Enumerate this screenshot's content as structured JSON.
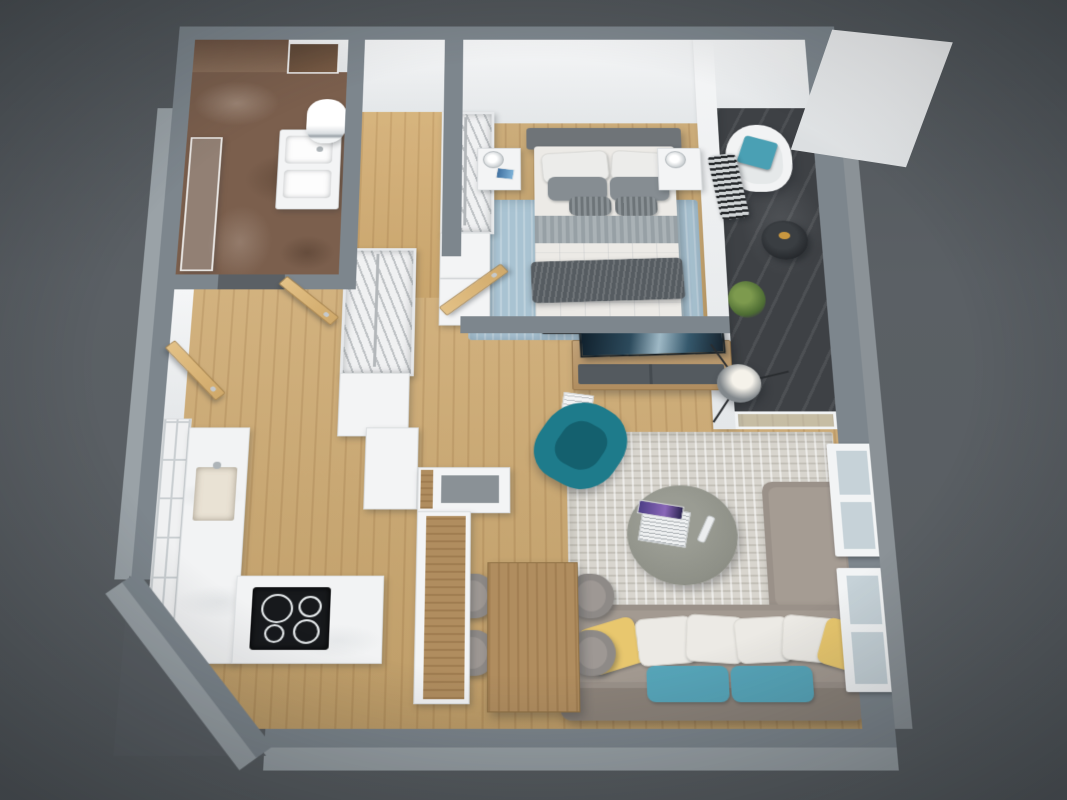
{
  "scene": {
    "description": "3D rendered top-down floor plan of a one-bedroom apartment",
    "view": "bird's-eye perspective render, no visible text labels"
  },
  "palette": {
    "bg": "#5b6065",
    "wallTop": "#7d868d",
    "wallSide": "#9aa2a7",
    "floorWood": "#cda970",
    "floorBathMarble": "#7b5f4d",
    "floorBalcony": "#3e4145",
    "rugBedroom": "#a9c3d2",
    "rugLiving": "#d8d5ce",
    "sofaGray": "#9a9189",
    "cushionTeal": "#57a5b9",
    "cushionYellow": "#e8c76e",
    "armchairTeal": "#1e7b8b",
    "doorWood": "#d0a96a",
    "counterWhite": "#f2f3f4",
    "cooktopBlack": "#17191c",
    "bedDuvet": "#eceae6",
    "bedThrow": "#565c61",
    "headboard": "#6f7478",
    "tvPanel": "#24323c",
    "tableWood": "#b08d5f"
  },
  "rooms": [
    {
      "id": "bathroom",
      "furniture": [
        "walk-in-shower-glass",
        "marble-wall",
        "vanity-with-sinks",
        "mirror",
        "water-heater",
        "door"
      ]
    },
    {
      "id": "hallway",
      "furniture": [
        "entrance-door",
        "open-wardrobe",
        "white-cabinet",
        "interior-doors"
      ]
    },
    {
      "id": "bedroom",
      "furniture": [
        "double-bed",
        "headboard",
        "pillows",
        "duvet",
        "throw-blanket",
        "nightstand-left",
        "nightstand-right",
        "table-lamps",
        "tablet",
        "open-wardrobe",
        "cabinets",
        "blue-rug",
        "tv-sideboard",
        "tv-screen"
      ]
    },
    {
      "id": "balcony",
      "furniture": [
        "lounge-chair",
        "teal-cushion",
        "accent-chair",
        "round-side-table",
        "plant",
        "glass-door"
      ]
    },
    {
      "id": "kitchen",
      "furniture": [
        "tall-grid-cabinet",
        "west-counter",
        "sink",
        "south-counter",
        "induction-cooktop",
        "peninsula-unit",
        "tall-cabinet"
      ]
    },
    {
      "id": "dining",
      "furniture": [
        "wood-table",
        "chair-1",
        "chair-2",
        "chair-3",
        "chair-4"
      ]
    },
    {
      "id": "living",
      "furniture": [
        "sectional-sofa",
        "white-pillows",
        "yellow-pillows",
        "teal-seat-cushions",
        "round-coffee-table",
        "laptop",
        "remote",
        "teal-armchair",
        "area-rug",
        "tripod-floor-lamp",
        "windows"
      ]
    }
  ]
}
